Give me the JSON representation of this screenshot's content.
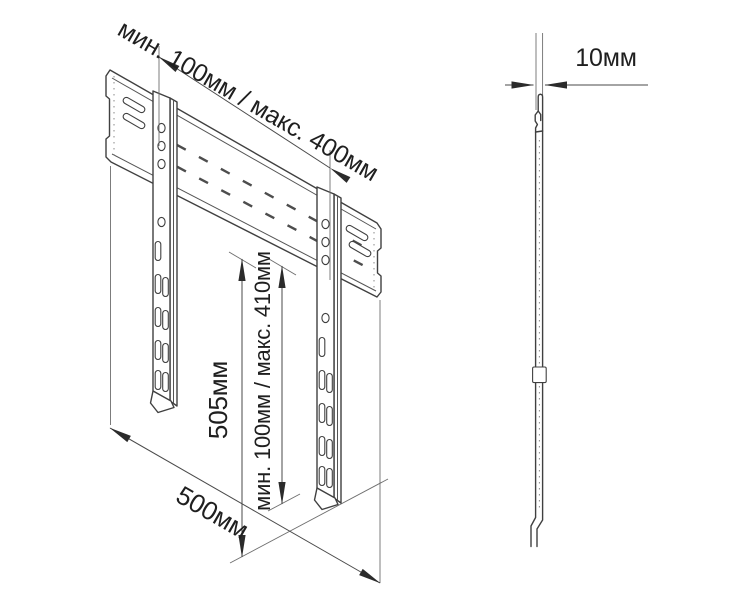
{
  "diagram": {
    "type": "technical-drawing",
    "subject": "tv-wall-mount-bracket",
    "colors": {
      "background": "#ffffff",
      "object_line": "#404040",
      "thin_line": "#6e6e6e",
      "arrow": "#2b2b2b",
      "text": "#1f1f1f"
    },
    "dimensions": {
      "top_span": "мин. 100мм / макс. 400мм",
      "arm_height": "505мм",
      "vertical_span": "мин. 100мм / макс. 410мм",
      "plate_width": "500мм",
      "thickness": "10мм"
    }
  }
}
